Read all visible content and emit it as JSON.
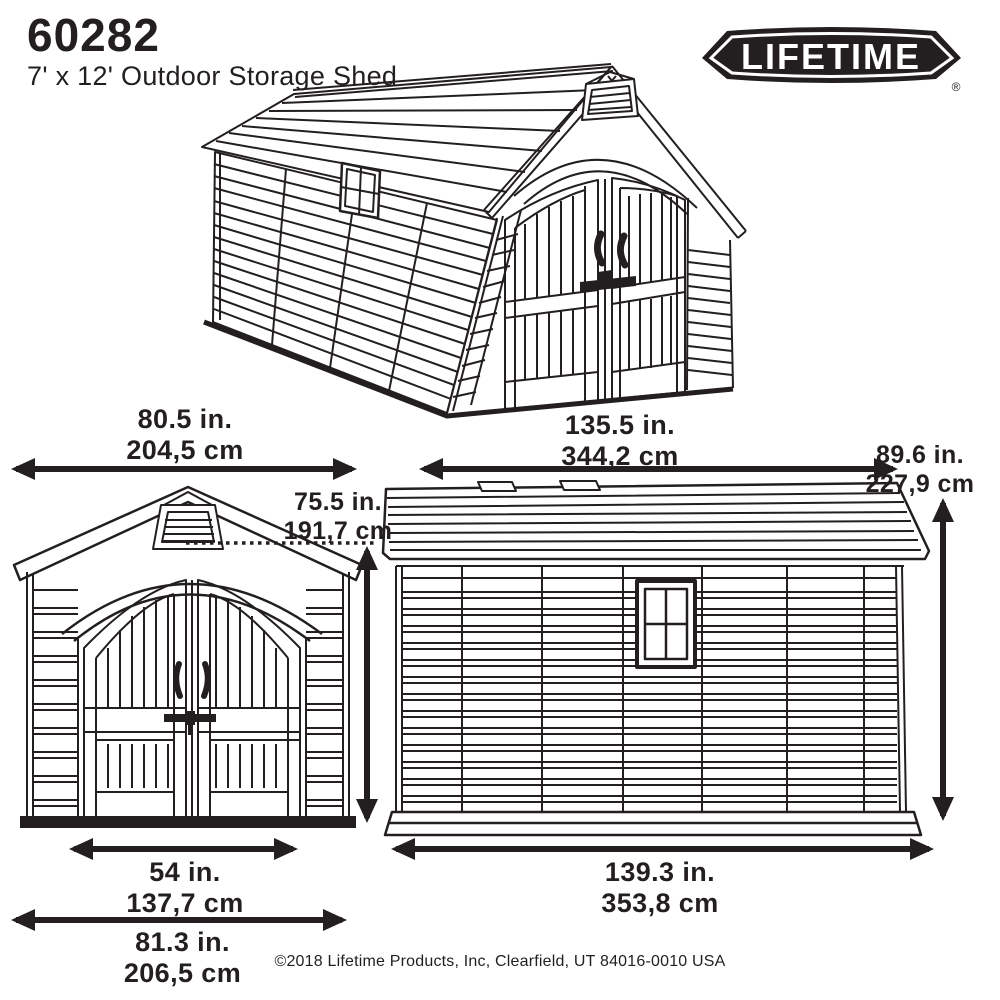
{
  "header": {
    "model": "60282",
    "subtitle": "7' x 12' Outdoor Storage Shed"
  },
  "logo": {
    "brand": "LIFETIME",
    "registered": "®"
  },
  "dimensions": {
    "front_width": {
      "in": "80.5 in.",
      "cm": "204,5 cm"
    },
    "front_height": {
      "in": "75.5 in.",
      "cm": "191,7 cm"
    },
    "door_width": {
      "in": "54 in.",
      "cm": "137,7 cm"
    },
    "front_overall_width": {
      "in": "81.3 in.",
      "cm": "206,5 cm"
    },
    "side_length": {
      "in": "135.5 in.",
      "cm": "344,2 cm"
    },
    "side_height": {
      "in": "89.6 in.",
      "cm": "227,9 cm"
    },
    "side_overall_length": {
      "in": "139.3 in.",
      "cm": "353,8 cm"
    }
  },
  "footer": {
    "copyright": "©2018 Lifetime Products, Inc, Clearfield, UT 84016-0010 USA"
  },
  "colors": {
    "ink": "#231f20",
    "background": "#ffffff"
  }
}
